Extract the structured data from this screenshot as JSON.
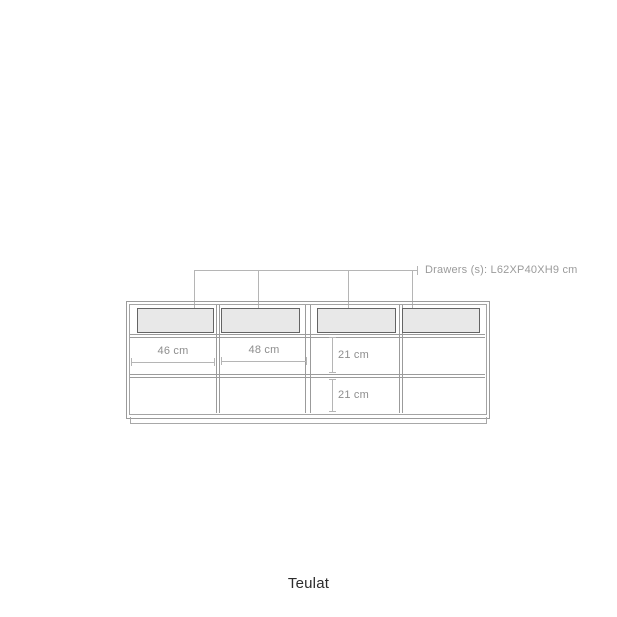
{
  "page": {
    "background": "#ffffff",
    "brand": "Teulat"
  },
  "diagram": {
    "type": "furniture-technical-drawing",
    "subject": "sideboard front elevation",
    "callout": {
      "label": "Drawers (s): L62XP40XH9 cm",
      "points_to": [
        "drawer-1",
        "drawer-2",
        "drawer-3",
        "drawer-4"
      ]
    },
    "cabinet": {
      "drawer_count": 4,
      "columns": 4,
      "shelf_rows": 2
    },
    "dimensions": [
      {
        "id": "column-1-width",
        "label": "46 cm",
        "orientation": "horizontal"
      },
      {
        "id": "column-2-width",
        "label": "48 cm",
        "orientation": "horizontal"
      },
      {
        "id": "shelf-row-1-height",
        "label": "21 cm",
        "orientation": "vertical"
      },
      {
        "id": "shelf-row-2-height",
        "label": "21 cm",
        "orientation": "vertical"
      }
    ],
    "colors": {
      "frame_line": "#9b9b9b",
      "drawer_outline": "#646464",
      "drawer_fill": "#e8e8e8",
      "annotation_line": "#b5b5b5",
      "dimension_text": "#8e8e8e",
      "callout_text": "#9b9b9b",
      "brand_text": "#2d2d2d"
    }
  }
}
